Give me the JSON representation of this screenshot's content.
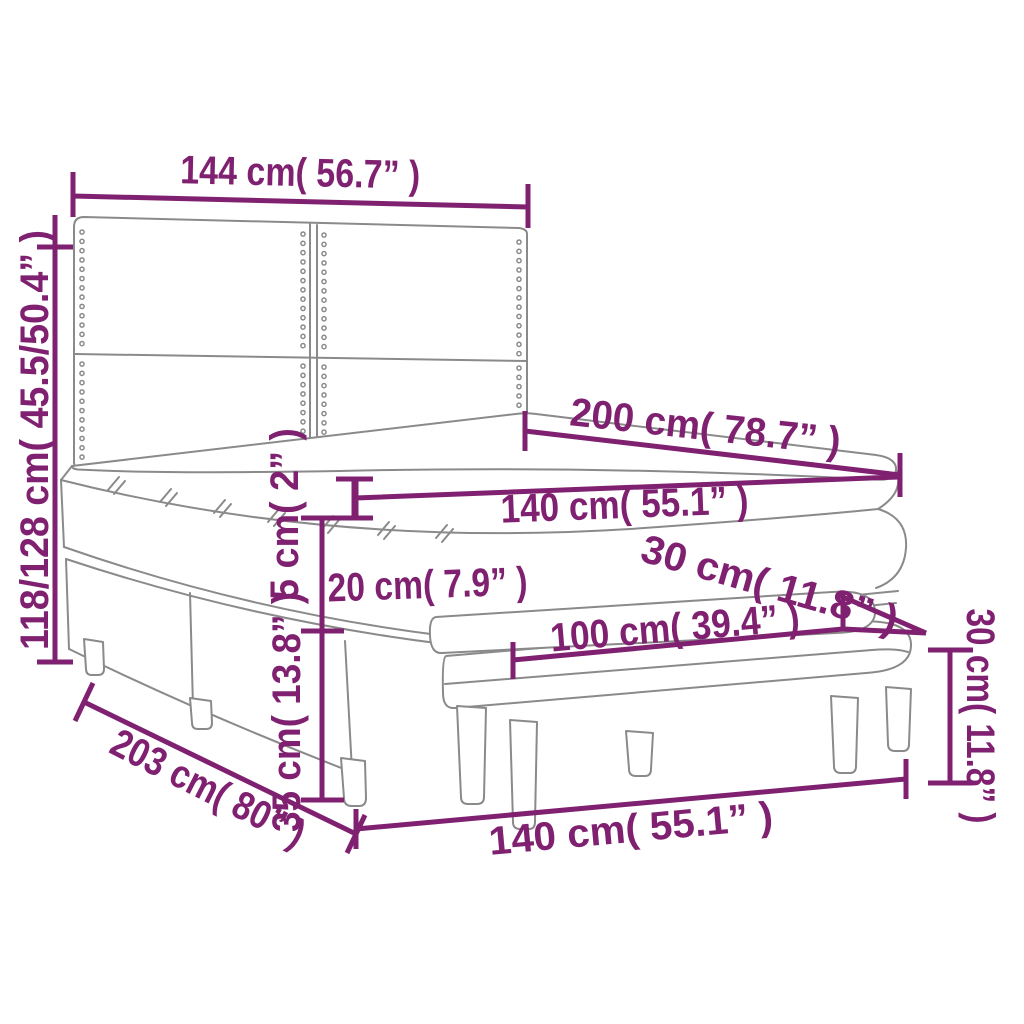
{
  "diagram": {
    "type": "furniture-dimension-diagram",
    "subject": "box-spring-bed-with-headboard-topper-and-bench",
    "colors": {
      "dimension_accent": "#7F2170",
      "drawing_line": "#8A8A8A",
      "background": "#FFFFFF"
    },
    "measurements": {
      "headboard_width": "144 cm( 56.7” )",
      "overall_height": "118/128 cm( 45.5/50.4” )",
      "bed_length": "200 cm( 78.7” )",
      "mattress_width": "140 cm( 55.1” )",
      "topper_thickness": "5 cm( 2” )",
      "boxspring_height": "20 cm( 7.9” )",
      "base_height": "35 cm( 13.8” )",
      "frame_length": "203 cm( 80” )",
      "bench_seat_length": "100 cm( 39.4” )",
      "bench_depth": "30 cm( 11.8” )",
      "bench_height": "30 cm( 11.8” )",
      "bench_overall_length": "140 cm( 55.1” )"
    }
  }
}
